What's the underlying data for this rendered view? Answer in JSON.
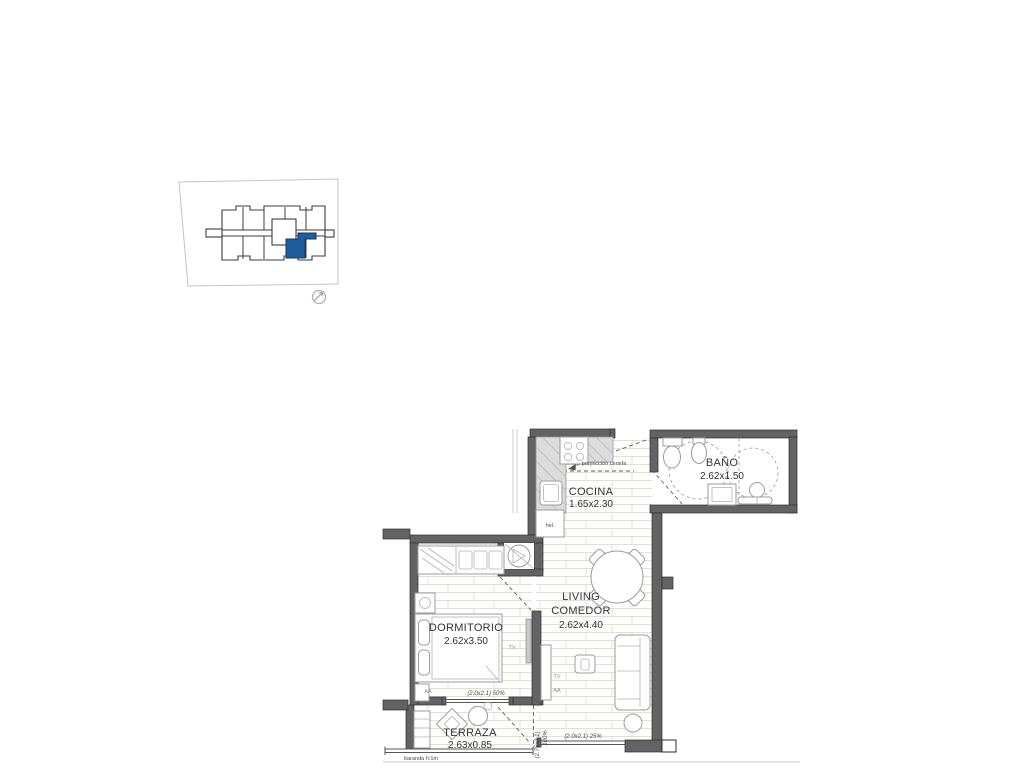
{
  "colors": {
    "background": "#ffffff",
    "wall_gray": "#636363",
    "highlight_blue": "#1e5c9e",
    "floor_line": "#e4dfd5",
    "text_dark": "#333333"
  },
  "keyplan": {
    "north_icon": "circular-north-arrow"
  },
  "rooms": [
    {
      "id": "cocina",
      "name": "COCINA",
      "dims": "1.65x2.30"
    },
    {
      "id": "bano",
      "name": "BAÑO",
      "dims": "2.62x1.50"
    },
    {
      "id": "living",
      "name_line1": "LIVING",
      "name_line2": "COMEDOR",
      "dims": "2.62x4.40"
    },
    {
      "id": "dormitorio",
      "name": "DORMITORIO",
      "dims": "2.62x3.50"
    },
    {
      "id": "terraza",
      "name": "TERRAZA",
      "dims": "2.63x0.85"
    }
  ],
  "annotations": {
    "proyeccion_cenefa": "proyección cenefa",
    "ventana_dormitorio": "(2.0x2.1) 50%",
    "ventana_terraza_medida": "(2.75x2.1)",
    "ventana_terraza_pct": "100%",
    "ventana_living": "(2.0x2.1) 25%",
    "baranda": "baranda h:1m",
    "heladera": "hel.",
    "tv": "TV",
    "aire_acondicionado": "AA"
  }
}
